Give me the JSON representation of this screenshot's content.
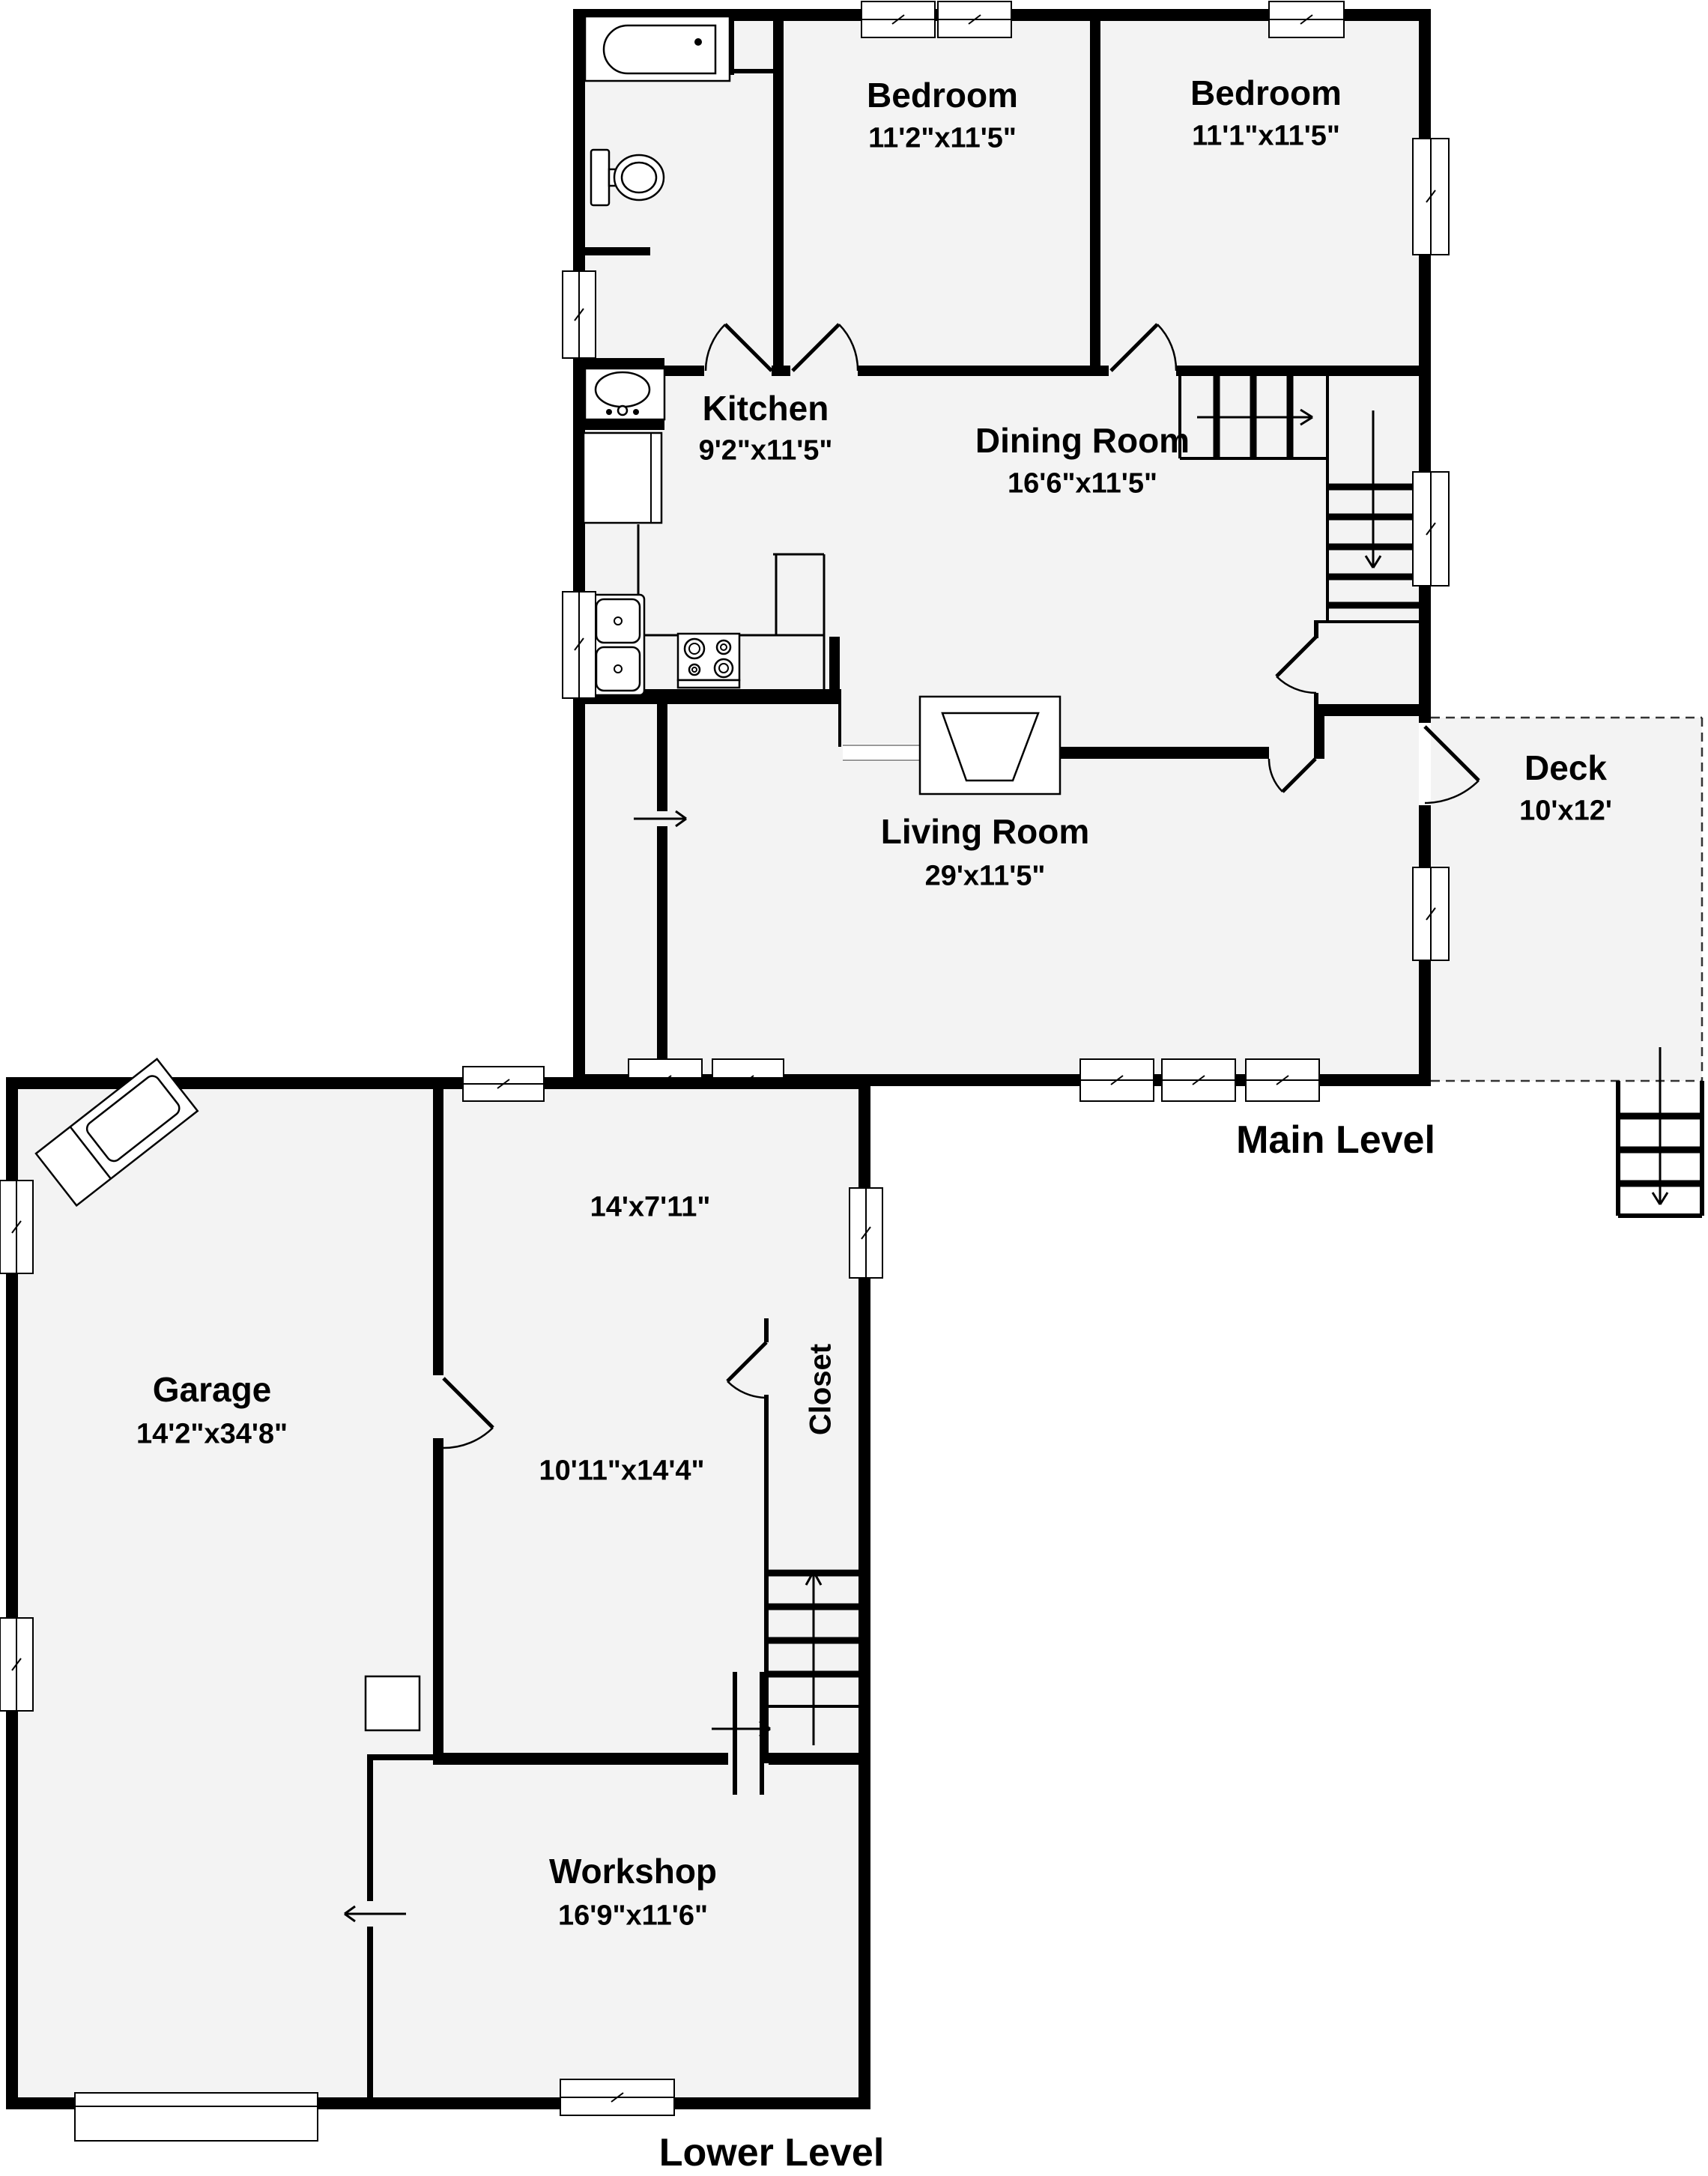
{
  "page_title": "Two-Level Floor Plan",
  "colors": {
    "floor": "#f3f3f3",
    "wall": "#000000",
    "background": "#ffffff"
  },
  "main_level": {
    "title": "Main Level",
    "rooms": {
      "bedroom1": {
        "name": "Bedroom",
        "dims": "11'2\"x11'5\""
      },
      "bedroom2": {
        "name": "Bedroom",
        "dims": "11'1\"x11'5\""
      },
      "kitchen": {
        "name": "Kitchen",
        "dims": "9'2\"x11'5\""
      },
      "dining_room": {
        "name": "Dining Room",
        "dims": "16'6\"x11'5\""
      },
      "living_room": {
        "name": "Living Room",
        "dims": "29'x11'5\""
      },
      "deck": {
        "name": "Deck",
        "dims": "10'x12'"
      }
    }
  },
  "lower_level": {
    "title": "Lower Level",
    "rooms": {
      "garage": {
        "name": "Garage",
        "dims": "14'2\"x34'8\""
      },
      "room_upper": {
        "dims": "14'x7'11\""
      },
      "room_lower": {
        "dims": "10'11\"x14'4\""
      },
      "closet": {
        "name": "Closet"
      },
      "workshop": {
        "name": "Workshop",
        "dims": "16'9\"x11'6\""
      }
    }
  }
}
